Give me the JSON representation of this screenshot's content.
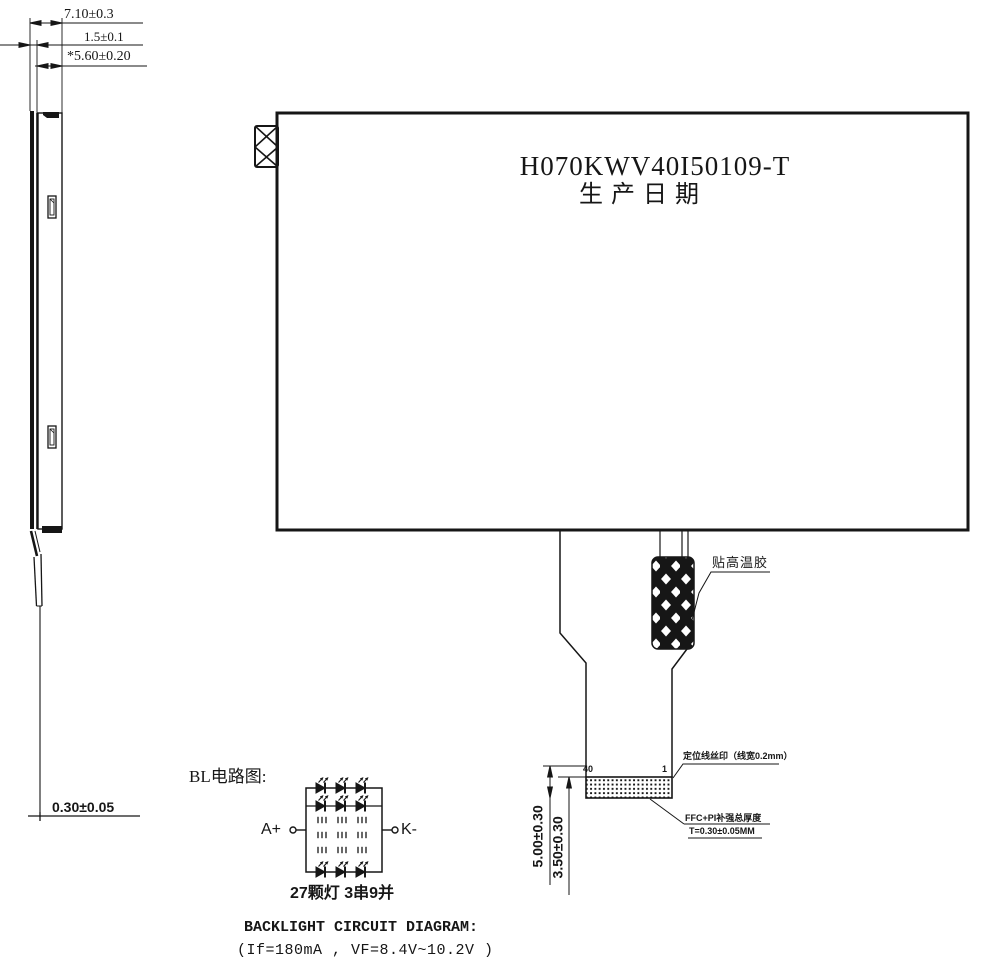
{
  "colors": {
    "ink": "#161616",
    "background": "#ffffff"
  },
  "side_view": {
    "dim_total_thickness": "7.10±0.3",
    "dim_front_lip": "1.5±0.1",
    "dim_body_thickness": "*5.60±0.20",
    "dim_ffc_thickness": "0.30±0.05"
  },
  "front_view": {
    "model_number": "H070KWV40I50109-T",
    "production_date_label": "生产日期"
  },
  "ffc": {
    "tape_label": "贴高温胶",
    "pin_first": "40",
    "pin_last": "1",
    "silkscreen_note": "定位线丝印（线宽0.2mm）",
    "stiffener_note_line1": "FFC+PI补强总厚度",
    "stiffener_note_line2": "T=0.30±0.05MM",
    "dim_tail_length": "5.00±0.30",
    "dim_contact_length": "3.50±0.30"
  },
  "backlight": {
    "section_title": "BL电路图:",
    "anode_label": "A+",
    "cathode_label": "K-",
    "led_configuration": "27颗灯 3串9并",
    "caption_en": "BACKLIGHT CIRCUIT DIAGRAM:",
    "electrical_spec": "(If=180mA ,  VF=8.4V~10.2V )"
  }
}
